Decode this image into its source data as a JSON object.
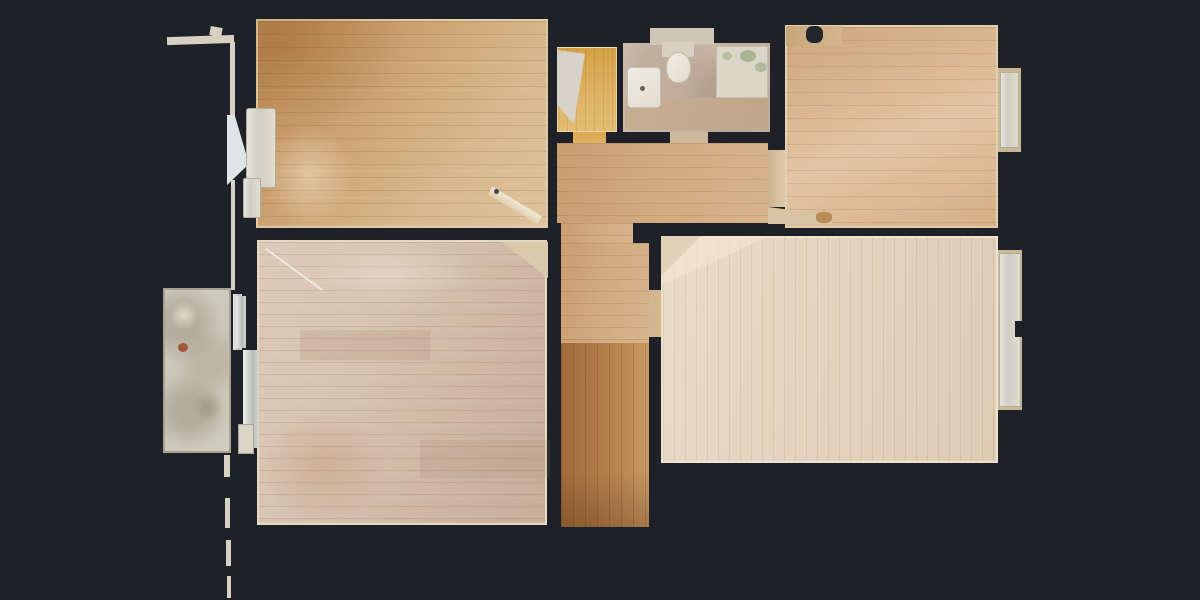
{
  "scene": {
    "kind": "top-down photogrammetry floor plan of an empty apartment, wooden floors on dark background",
    "visible_text": "none"
  },
  "palette": {
    "bg": "#1e2127",
    "wood-warm": "#c2945f",
    "wood-pink": "#d6c2b0",
    "wood-pale": "#e4d4bf",
    "wood-orange": "#b5834e",
    "closet-yellow": "#ddb264",
    "bath-tile": "#c6b3a4",
    "fixture-white": "#edeae2",
    "balcony-gray": "#cfccc0",
    "baseboard": "#e2d2b0"
  },
  "shapes": [
    {
      "name": "outer-wall-top-ledge",
      "cls": "wallline",
      "x": 167,
      "y": 36,
      "w": 67,
      "h": 8,
      "rot": -2
    },
    {
      "name": "outer-wall-tick",
      "cls": "wallline",
      "x": 210,
      "y": 27,
      "w": 12,
      "h": 9,
      "rot": 10
    },
    {
      "name": "outer-wall-vertical-upper",
      "cls": "wallline",
      "x": 230,
      "y": 42,
      "w": 5,
      "h": 78
    },
    {
      "name": "outer-wall-flare",
      "x": 227,
      "y": 115,
      "w": 22,
      "h": 70,
      "bg": "#dfe5e6",
      "clip": "polygon(0 0, 35% 0, 100% 70%, 0 100%)"
    },
    {
      "name": "outer-wall-vertical-mid",
      "cls": "wallline",
      "x": 231,
      "y": 180,
      "w": 4,
      "h": 110
    },
    {
      "name": "outer-wall-dash-1",
      "cls": "wallline",
      "x": 224,
      "y": 455,
      "w": 6,
      "h": 22
    },
    {
      "name": "outer-wall-dash-2",
      "cls": "wallline",
      "x": 225,
      "y": 498,
      "w": 5,
      "h": 30
    },
    {
      "name": "outer-wall-dash-3",
      "cls": "wallline",
      "x": 226,
      "y": 540,
      "w": 5,
      "h": 26
    },
    {
      "name": "outer-wall-dash-4",
      "cls": "wallline",
      "x": 227,
      "y": 576,
      "w": 4,
      "h": 22
    },
    {
      "name": "balcony-slab",
      "cls": "slab-balcony",
      "x": 163,
      "y": 288,
      "w": 68,
      "h": 165
    },
    {
      "name": "balcony-stain-rust",
      "x": 178,
      "y": 343,
      "w": 10,
      "h": 9,
      "bg": "#a3543c",
      "r": "50%"
    },
    {
      "name": "balcony-stain-light",
      "x": 170,
      "y": 300,
      "w": 28,
      "h": 30,
      "bg": "radial-gradient(circle,rgba(233,228,214,.8),rgba(0,0,0,0) 70%)"
    },
    {
      "name": "balcony-stain-dark",
      "x": 195,
      "y": 390,
      "w": 26,
      "h": 34,
      "bg": "radial-gradient(circle,rgba(150,140,116,.6),rgba(0,0,0,0) 70%)"
    },
    {
      "name": "balcony-door-frame-a",
      "cls": "metal",
      "x": 233,
      "y": 294,
      "w": 9,
      "h": 56
    },
    {
      "name": "balcony-door-frame-b",
      "cls": "metal",
      "x": 243,
      "y": 350,
      "w": 15,
      "h": 98
    },
    {
      "name": "room-top-left-floor",
      "cls": "floor-tl",
      "x": 256,
      "y": 19,
      "w": 292,
      "h": 209
    },
    {
      "name": "room-top-left-warm-shading",
      "x": 256,
      "y": 19,
      "w": 150,
      "h": 110,
      "bg": "radial-gradient(ellipse at 20% 20%, rgba(150,90,35,.30), rgba(0,0,0,0) 70%)"
    },
    {
      "name": "room-top-left-sun-streak",
      "x": 258,
      "y": 120,
      "w": 100,
      "h": 110,
      "bg": "radial-gradient(ellipse, rgba(255,246,228,.40), rgba(0,0,0,0) 65%)"
    },
    {
      "name": "window-sill-top-left-upper",
      "cls": "sill",
      "x": 246,
      "y": 108,
      "w": 30,
      "h": 80,
      "r": "3px"
    },
    {
      "name": "window-sill-top-left-lower",
      "cls": "sill",
      "x": 243,
      "y": 178,
      "w": 18,
      "h": 40,
      "r": "2px"
    },
    {
      "name": "open-door-leaf",
      "cls": "pivot-left",
      "x": 490,
      "y": 186,
      "w": 58,
      "h": 9,
      "rot": 31,
      "bg": "linear-gradient(180deg,#f2ead6,#ddcfae)",
      "z": 5
    },
    {
      "name": "door-handle-dot",
      "x": 494,
      "y": 189,
      "w": 5,
      "h": 5,
      "bg": "#44474d",
      "r": "50%",
      "z": 6
    },
    {
      "name": "closet-floor",
      "cls": "floor-closet",
      "x": 557,
      "y": 47,
      "w": 60,
      "h": 85
    },
    {
      "name": "closet-shelf-wedge",
      "x": 557,
      "y": 50,
      "w": 28,
      "h": 78,
      "bg": "#d7d3c9",
      "clip": "polygon(0 0,100% 5%,60% 95%,0 70%)"
    },
    {
      "name": "closet-door-threshold",
      "x": 573,
      "y": 132,
      "w": 33,
      "h": 22,
      "bg": "linear-gradient(180deg,#d9a84e,#e3bd70)"
    },
    {
      "name": "bathroom-floor",
      "cls": "tile-bath",
      "x": 623,
      "y": 43,
      "w": 147,
      "h": 89
    },
    {
      "name": "bathroom-niche",
      "x": 650,
      "y": 28,
      "w": 64,
      "h": 17,
      "bg": "#cfc6b8"
    },
    {
      "name": "bathroom-bottom-band",
      "x": 625,
      "y": 98,
      "w": 143,
      "h": 32,
      "bg": "linear-gradient(110deg,#c7ae93,#bfa589)"
    },
    {
      "name": "toilet-cistern",
      "x": 662,
      "y": 42,
      "w": 32,
      "h": 15,
      "bg": "#d7d0c2",
      "r": "2px"
    },
    {
      "name": "toilet-bowl",
      "cls": "white-fixture",
      "x": 666,
      "y": 52,
      "w": 25,
      "h": 31,
      "r": "50% 50% 45% 45%"
    },
    {
      "name": "bathroom-sink",
      "cls": "white-fixture",
      "x": 627,
      "y": 67,
      "w": 34,
      "h": 41,
      "r": "4px"
    },
    {
      "name": "sink-drain-dot",
      "x": 640,
      "y": 86,
      "w": 5,
      "h": 5,
      "bg": "#6b6458",
      "r": "50%"
    },
    {
      "name": "shower-tray",
      "x": 716,
      "y": 46,
      "w": 52,
      "h": 52,
      "bg": "#dad7c8",
      "border": "1px solid #c2bfae"
    },
    {
      "name": "shower-moss-spot-1",
      "x": 740,
      "y": 50,
      "w": 16,
      "h": 12,
      "bg": "#aab394",
      "r": "50%"
    },
    {
      "name": "shower-moss-spot-2",
      "x": 755,
      "y": 62,
      "w": 12,
      "h": 10,
      "bg": "#b2ba9c",
      "r": "50%"
    },
    {
      "name": "shower-moss-spot-3",
      "x": 722,
      "y": 52,
      "w": 10,
      "h": 8,
      "bg": "#b8bfa6",
      "r": "50%"
    },
    {
      "name": "bathroom-door-threshold",
      "x": 670,
      "y": 132,
      "w": 38,
      "h": 13,
      "bg": "#cdb99b"
    },
    {
      "name": "room-top-right-floor",
      "cls": "floor-tr",
      "x": 785,
      "y": 25,
      "w": 213,
      "h": 203
    },
    {
      "name": "room-top-right-corner-patch",
      "x": 786,
      "y": 26,
      "w": 56,
      "h": 20,
      "bg": "linear-gradient(90deg,#c8a67c,#d4b68c)"
    },
    {
      "name": "room-top-right-corner-blob",
      "x": 806,
      "y": 26,
      "w": 17,
      "h": 17,
      "bg": "#23262c",
      "r": "40%"
    },
    {
      "name": "window-niche-top-right",
      "x": 998,
      "y": 68,
      "w": 23,
      "h": 84,
      "bg": "#cbb693"
    },
    {
      "name": "window-sill-top-right",
      "cls": "sill",
      "x": 1000,
      "y": 72,
      "w": 19,
      "h": 76
    },
    {
      "name": "doorway-threshold-top-right",
      "x": 768,
      "y": 150,
      "w": 17,
      "h": 57,
      "bg": "linear-gradient(90deg,#cdb491,#dcc9a9)"
    },
    {
      "name": "wall-reveal-wedge-top-right-room",
      "x": 768,
      "y": 204,
      "w": 64,
      "h": 20,
      "bg": "#d8c3a2",
      "clip": "polygon(0 15%,100% 55%,100% 100%,0 100%)"
    },
    {
      "name": "wall-reveal-blob",
      "x": 816,
      "y": 212,
      "w": 16,
      "h": 11,
      "bg": "#b78d55",
      "r": "40%"
    },
    {
      "name": "hallway-floor",
      "cls": "floor-hall",
      "x": 557,
      "y": 143,
      "w": 211,
      "h": 80
    },
    {
      "name": "corridor-doorway-floor",
      "cls": "floor-hall",
      "x": 561,
      "y": 223,
      "w": 72,
      "h": 21
    },
    {
      "name": "corridor-upper-floor",
      "cls": "floor-hall",
      "x": 561,
      "y": 243,
      "w": 88,
      "h": 100
    },
    {
      "name": "corridor-lower-floor",
      "cls": "floor-cor-bot",
      "x": 561,
      "y": 343,
      "w": 88,
      "h": 184
    },
    {
      "name": "corridor-bottom-shade",
      "x": 561,
      "y": 470,
      "w": 88,
      "h": 57,
      "bg": "linear-gradient(180deg,rgba(0,0,0,0),rgba(60,30,5,.25))"
    },
    {
      "name": "doorway-threshold-bottom-right",
      "x": 649,
      "y": 290,
      "w": 12,
      "h": 47,
      "bg": "#d2b68d"
    },
    {
      "name": "wall-reveal-wedge-bottom-left-room",
      "x": 502,
      "y": 242,
      "w": 46,
      "h": 36,
      "bg": "#dbc9ac",
      "clip": "polygon(0 0,100% 0,100% 100%)",
      "z": 4
    },
    {
      "name": "room-bottom-left-floor",
      "cls": "floor-bl",
      "x": 257,
      "y": 240,
      "w": 290,
      "h": 285
    },
    {
      "name": "room-bottom-left-warm-shading",
      "x": 258,
      "y": 410,
      "w": 130,
      "h": 114,
      "bg": "radial-gradient(ellipse, rgba(185,125,70,.25), rgba(0,0,0,0) 70%)"
    },
    {
      "name": "room-bottom-left-light-shading",
      "x": 300,
      "y": 243,
      "w": 180,
      "h": 60,
      "bg": "radial-gradient(ellipse, rgba(255,248,238,.28), rgba(0,0,0,0) 70%)"
    },
    {
      "name": "room-bottom-left-plank-patch-1",
      "x": 300,
      "y": 330,
      "w": 130,
      "h": 30,
      "bg": "rgba(160,120,95,.16)"
    },
    {
      "name": "room-bottom-left-plank-patch-2",
      "x": 420,
      "y": 440,
      "w": 130,
      "h": 38,
      "bg": "rgba(160,120,95,.14)"
    },
    {
      "name": "scan-artifact-line",
      "cls": "pivot-left",
      "x": 266,
      "y": 248,
      "w": 70,
      "h": 2,
      "rot": 36,
      "bg": "rgba(255,255,255,.6)"
    },
    {
      "name": "radiator-strip-a",
      "cls": "metal",
      "x": 236,
      "y": 296,
      "w": 10,
      "h": 52
    },
    {
      "name": "radiator-strip-b",
      "cls": "metal",
      "x": 244,
      "y": 350,
      "w": 15,
      "h": 98
    },
    {
      "name": "radiator-block-c",
      "x": 238,
      "y": 424,
      "w": 16,
      "h": 30,
      "bg": "#d9d4c6",
      "border": "1px solid #aaa496"
    },
    {
      "name": "room-bottom-right-floor",
      "cls": "floor-br",
      "x": 661,
      "y": 236,
      "w": 337,
      "h": 227
    },
    {
      "name": "room-bottom-right-light-triangle",
      "x": 661,
      "y": 236,
      "w": 108,
      "h": 50,
      "bg": "rgba(242,231,209,.65)",
      "clip": "polygon(0 0,100% 0,0 100%)"
    },
    {
      "name": "wall-reveal-wedge-bottom-right-room",
      "x": 661,
      "y": 236,
      "w": 40,
      "h": 40,
      "bg": "#e0d2b8",
      "clip": "polygon(0 0,100% 0,0 100%)"
    },
    {
      "name": "window-niche-bottom-right",
      "x": 998,
      "y": 250,
      "w": 24,
      "h": 160,
      "bg": "#ccb894"
    },
    {
      "name": "window-sill-bottom-right",
      "cls": "sill",
      "x": 999,
      "y": 253,
      "w": 22,
      "h": 154
    },
    {
      "name": "window-niche-notch",
      "x": 1015,
      "y": 321,
      "w": 9,
      "h": 16,
      "bg": "#1e2127",
      "z": 4
    }
  ]
}
